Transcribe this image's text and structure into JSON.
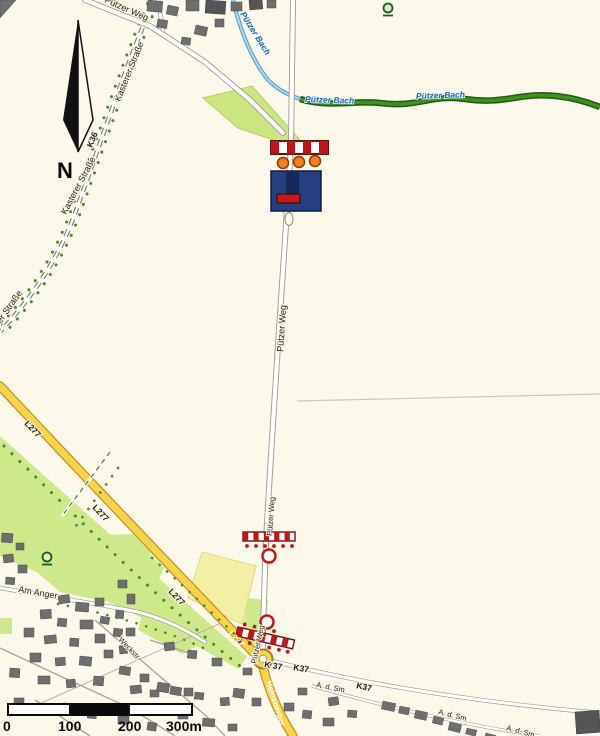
{
  "map": {
    "compass": {
      "label": "N"
    },
    "scalebar": {
      "ticks": [
        "0",
        "100",
        "200",
        "300m"
      ]
    },
    "streets": {
      "putzer_weg": "Pützer Weg",
      "kasterer_strasse": "Kasterer Straße",
      "k36": "K36",
      "l277": "L277",
      "k37": "K37",
      "k37_spaced": "K 37",
      "am_anger": "Am Anger",
      "heinsberger": "Heinsberger",
      "weckstr": "Weckstr.",
      "a_d_sm": "A. d. Sm"
    },
    "waters": {
      "putzer_bach": "Pützer Bach"
    },
    "icons": {
      "north_arrow": "compass-north-arrow",
      "barrier": "road-closure-barrier",
      "dead_end_sign": "no-through-road-sign",
      "wayside_cross": "wayside-cross",
      "roundabout": "roundabout"
    },
    "colors": {
      "background": "#fdf9ea",
      "field_green": "#cde98c",
      "field_pale_yellow": "#f3efa5",
      "road_yellow": "#f7d44a",
      "stream_green": "#3f8f22",
      "stream_blue": "#74b8dc",
      "barrier_red": "#c01616",
      "sign_navy": "#24407e",
      "lamp_orange": "#f08018"
    }
  }
}
